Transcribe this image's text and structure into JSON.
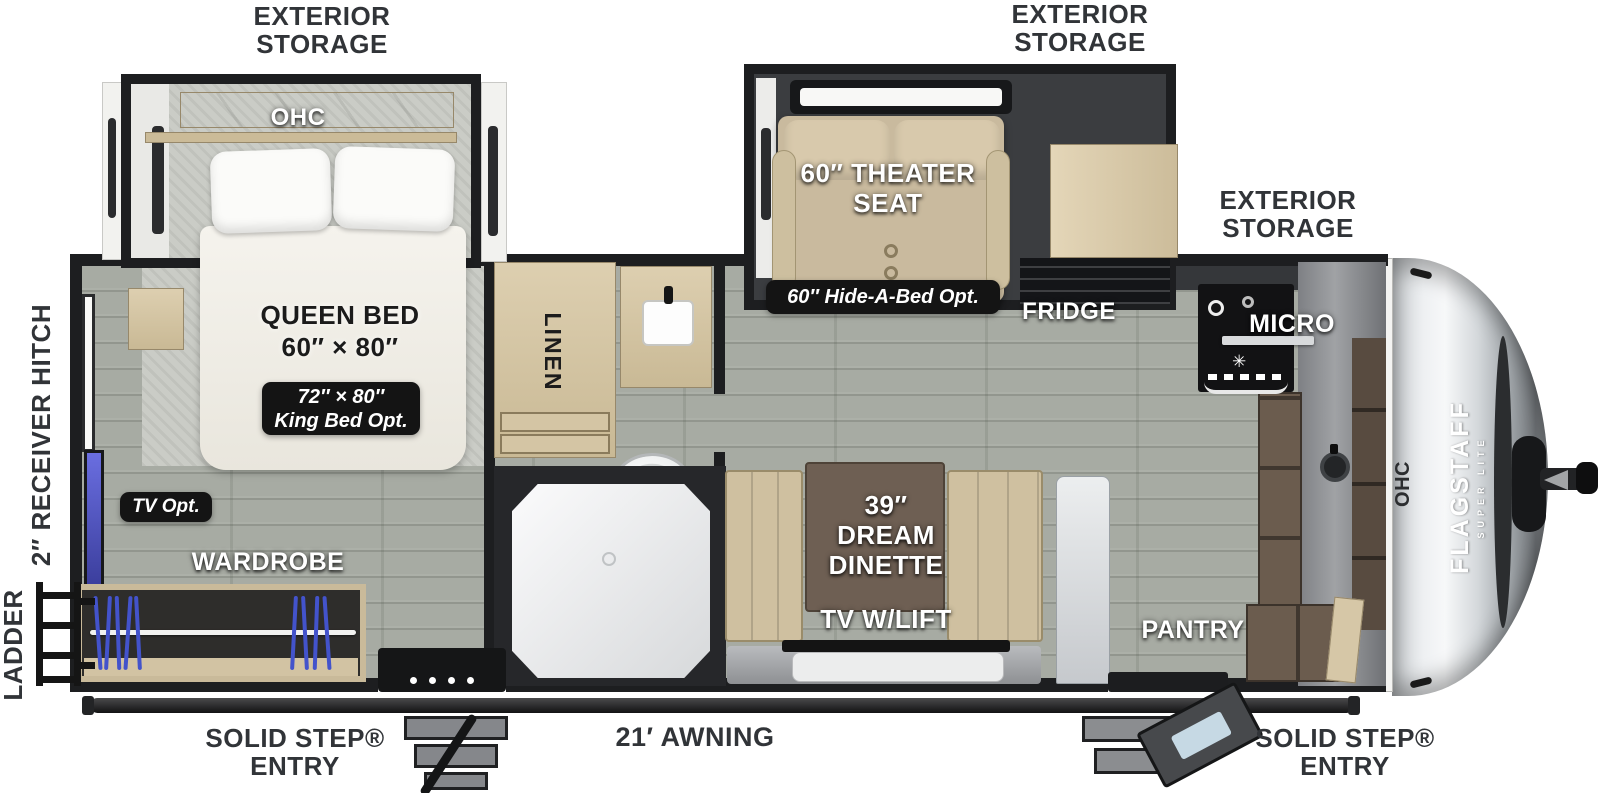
{
  "exterior": {
    "storage_rear_l1": "EXTERIOR",
    "storage_rear_l2": "STORAGE",
    "storage_mid_l1": "EXTERIOR",
    "storage_mid_l2": "STORAGE",
    "storage_front_l1": "EXTERIOR",
    "storage_front_l2": "STORAGE",
    "receiver_hitch": "2″ RECEIVER HITCH",
    "ladder": "LADDER",
    "entry_left_l1": "SOLID STEP®",
    "entry_left_l2": "ENTRY",
    "entry_right_l1": "SOLID STEP®",
    "entry_right_l2": "ENTRY",
    "awning": "21′ AWNING"
  },
  "bedroom": {
    "ohc": "OHC",
    "queen_l1": "QUEEN BED",
    "queen_l2": "60″ × 80″",
    "king_opt_l1": "72″ × 80″",
    "king_opt_l2": "King Bed Opt.",
    "tv_opt": "TV Opt.",
    "wardrobe": "WARDROBE"
  },
  "bath": {
    "linen": "LINEN"
  },
  "living": {
    "theater_l1": "60″ THEATER",
    "theater_l2": "SEAT",
    "hide_a_bed": "60″ Hide-A-Bed Opt.",
    "dinette_l1": "39″",
    "dinette_l2": "DREAM",
    "dinette_l3": "DINETTE",
    "tv_lift": "TV W/LIFT"
  },
  "kitchen": {
    "fridge": "FRIDGE",
    "micro": "MICRO",
    "pantry": "PANTRY",
    "front_ohc": "OHC",
    "burner_glyph": "✳"
  },
  "brand": {
    "name": "FLAGSTAFF",
    "sub": "SUPER LITE"
  },
  "colors": {
    "wall": "#1d1e20",
    "floor": "#a7aba3",
    "cabinet_tan": "#d8c9a9",
    "badge_bg": "#141414",
    "hanger_blue": "#4353cb",
    "tv_blue": "#5a5fd8",
    "seat_beige": "#c9ba9e",
    "table_brown": "#6e5f53",
    "cap_silver": "#d4d8db"
  }
}
